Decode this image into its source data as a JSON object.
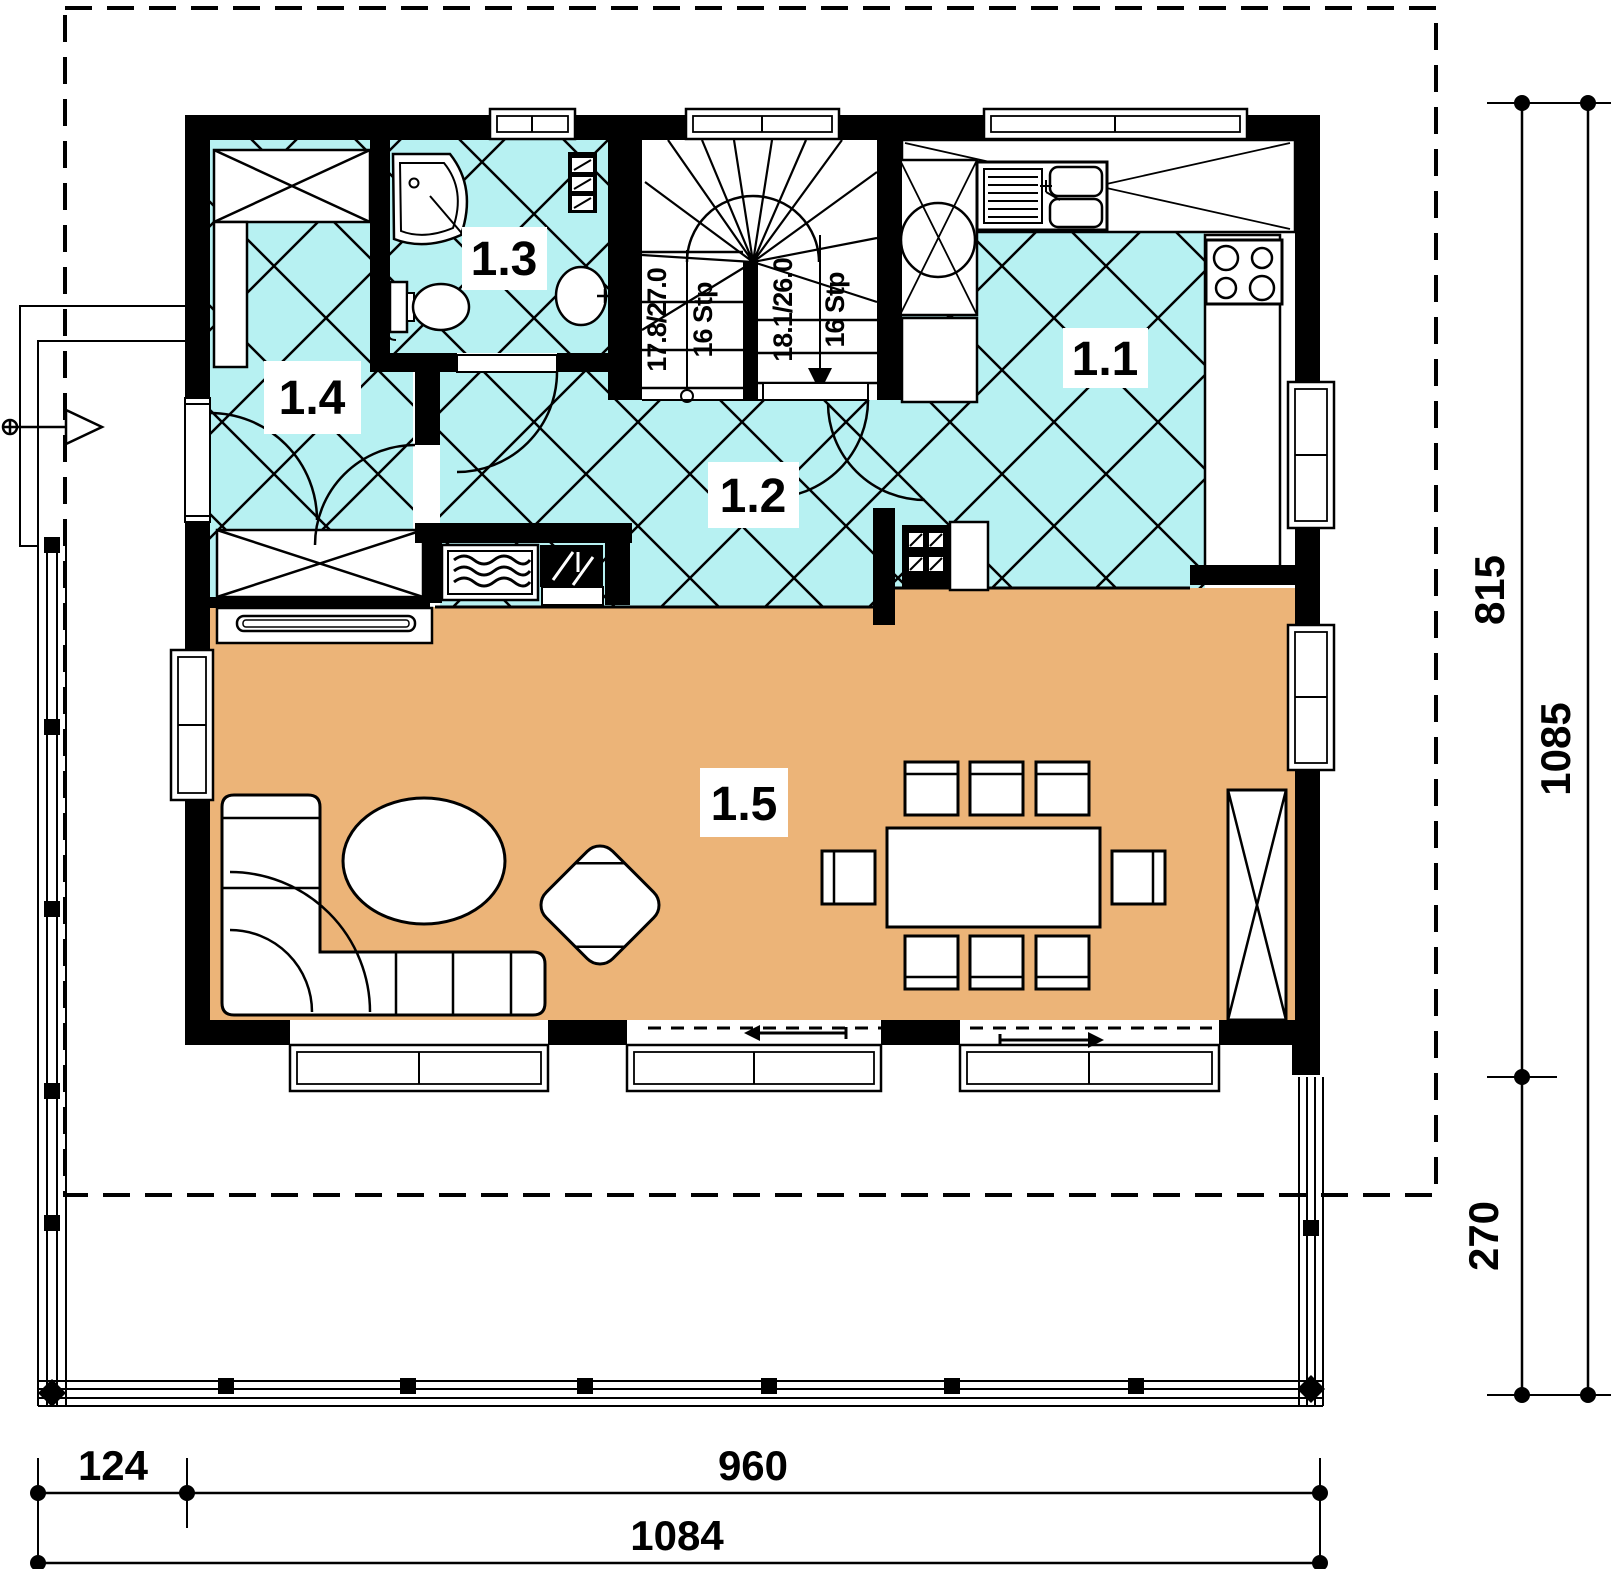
{
  "floor_plan": {
    "rooms": [
      {
        "label": "1.1"
      },
      {
        "label": "1.2"
      },
      {
        "label": "1.3"
      },
      {
        "label": "1.4"
      },
      {
        "label": "1.5"
      }
    ],
    "stairs": {
      "left_flight": {
        "rise_run": "17.8/27.0",
        "steps": "16 Stp"
      },
      "right_flight": {
        "rise_run": "18.1/26.0",
        "steps": "16 Stp"
      }
    },
    "dimensions": {
      "right": [
        "815",
        "1085",
        "270"
      ],
      "bottom": [
        "124",
        "960",
        "1084"
      ]
    },
    "colors": {
      "tile_floor": "#b7f1f2",
      "wood_floor": "#ecb478",
      "wall": "#000000",
      "background": "#ffffff"
    }
  }
}
